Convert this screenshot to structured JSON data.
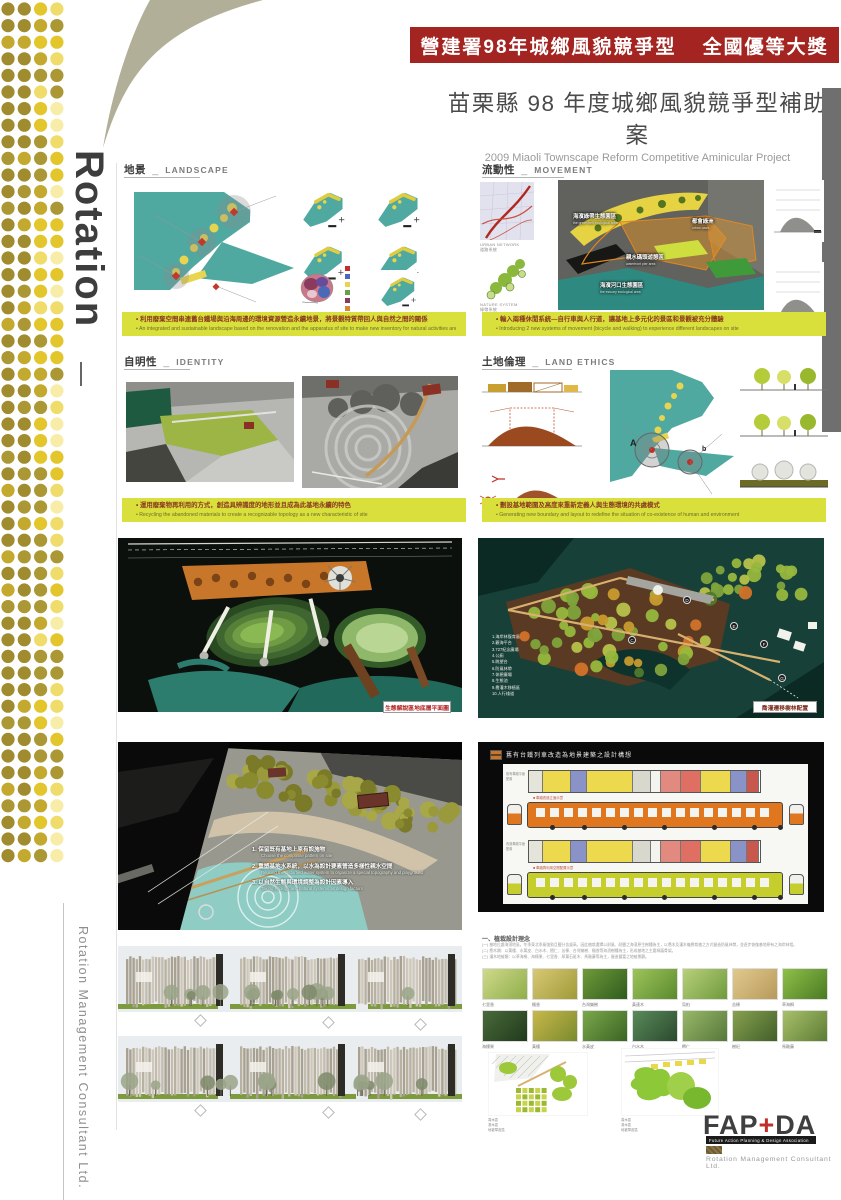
{
  "banner": {
    "left": "營建署98年城鄉風貌競爭型",
    "right": "全國優等大獎"
  },
  "title": {
    "zh": "苗栗縣 98 年度城鄉風貌競爭型補助案",
    "en": "2009 Miaoli Townscape Reform Competitive Aminicular Project"
  },
  "brand": {
    "rotation": "Rotation",
    "company_side": "Rotation Management Consultant Ltd.",
    "dot_palette": [
      "#a08c2e",
      "#ab9733",
      "#c3a92e",
      "#e3c52c",
      "#efdc6a",
      "#f7eda8"
    ]
  },
  "sections": {
    "landscape": {
      "zh": "地景",
      "sep": "_",
      "en": "LANDSCAPE",
      "bullet_zh": "利用廢棄空間串連舊台鐵場與沿海周邊的環境資源營造永續地景，將景觀特質帶回人與自然之間的關係",
      "bullet_en": "An integrated and sustainable landscape based on the renovation and the apparatus of site to make new inventory for natural activities and environment"
    },
    "movement": {
      "zh": "流動性",
      "sep": "_",
      "en": "MOVEMENT",
      "bullet_zh": "輸入兩種休閒系統—自行車與人行道，讓基地上多元化的景區和景觀被充分體驗",
      "bullet_en": "Introducing 2 new systems of movement (bicycle and walking) to experience different landscapes on site",
      "map1_en": "URBAN NETWORK",
      "map1_zh": "道路系統",
      "map2_en": "NATURE SYSTEM",
      "map2_zh": "綠帶系統",
      "aerial_labels": [
        {
          "zh": "海濱綠帶生態園區",
          "en": "the green belt ecological area"
        },
        {
          "zh": "都會綠洲",
          "en": "urban oasis"
        },
        {
          "zh": "親水碼頭遊憩區",
          "en": "waterfront pier area"
        },
        {
          "zh": "海濱河口生態園區",
          "en": "the estuary ecological area"
        }
      ]
    },
    "identity": {
      "zh": "自明性",
      "sep": "_",
      "en": "IDENTITY",
      "bullet_zh": "運用廢棄物再利用的方式，創造具辨識度的地形並且成為此基地永續的特色",
      "bullet_en": "Recycling the abandoned materials to create a recognizable topology as a new characteristic of site"
    },
    "land_ethics": {
      "zh": "土地倫理",
      "sep": "_",
      "en": "LAND ETHICS",
      "bullet_zh": "劃設基地範圍及高度來重新定義人與生態環境的共處模式",
      "bullet_en": "Generating new boundary and layout to redefine the situation of co-existence of human and environment",
      "marker_a": "A",
      "marker_b": "b"
    }
  },
  "plans": {
    "eco_label": "生態解說區地底層平面圖",
    "tree_label": "喬灌遷移樹林配置",
    "tree_legend": [
      "1.海岸林復育區",
      "2.觀海平台",
      "3.727紀念廣場",
      "4.公廁",
      "5.眺望台",
      "6.防風林帶",
      "7.休憩廣場",
      "8.生態池",
      "9.喬灌木移植區",
      "10.人行棧道"
    ],
    "tree_markers": [
      "C",
      "D",
      "E",
      "F",
      "G"
    ]
  },
  "perspective": {
    "notes": [
      {
        "no": "1.",
        "zh": "保留既有基地上原有設施物",
        "en": "Choose the composite pattern on site"
      },
      {
        "no": "2.",
        "zh": "重塑基地水系統，以水為設計要素營造多樣性親水空間",
        "en": "Reusing the disturbed water system to organize a special topography and playground"
      },
      {
        "no": "3.",
        "zh": "以自然生態與環境調整為設計因素導入",
        "en": "Taking ecology and natural systems as design factors"
      }
    ]
  },
  "train": {
    "title": "舊有台鐵列車改造為地景建築之設計構想",
    "rowA_label": "既有車廂平面配置",
    "rowC_label": "改造車廂平面配置",
    "noteA": "■ 車廂改造立面示意",
    "noteB": "■ 車廂再利用空間配置示意"
  },
  "planting": {
    "heading": "一、植栽設計理念",
    "body": [
      "(一) 基地位處海濱地區，冬季東北季風強勁且鹽分含量高，因此植栽選擇以耐風、耐鹽之海濱原生樹種為主，以喬木及灌木複層栽植之方式營造防風林帶，並逐步恢復基地原有之海岸林相。",
      "(二) 喬木類：以黃槿、水黃皮、白水木、欖仁、苦楝、台灣欒樹、楓香等海濱樹種為主，形成基地之主要綠蔭骨架。",
      "(三) 灌木地被類：以草海桐、海檬果、七里香、厚葉石斑木、馬鞍藤等為主，營造豐富之地被景觀。"
    ],
    "plan_legend": [
      "喬木區",
      "灌木區",
      "地被草皮區"
    ],
    "row1": [
      "七里香",
      "楓香",
      "台灣欒樹",
      "黃連木",
      "烏桕",
      "苦楝",
      "草海桐"
    ],
    "row2": [
      "海檬果",
      "黃槿",
      "水黃皮",
      "白水木",
      "欖仁",
      "樹杞",
      "馬鞍藤"
    ]
  },
  "logo": {
    "fap": "FAP",
    "plus": "+",
    "da": "DA",
    "assoc": "Future Action Planning & Design Association",
    "company": "Rotation Management Consultant Ltd."
  },
  "colors": {
    "banner_red": "#a32420",
    "caption_yellow": "#d9df3b",
    "teal": "#4fa9a1",
    "accent_yellow": "#e8d44e"
  }
}
